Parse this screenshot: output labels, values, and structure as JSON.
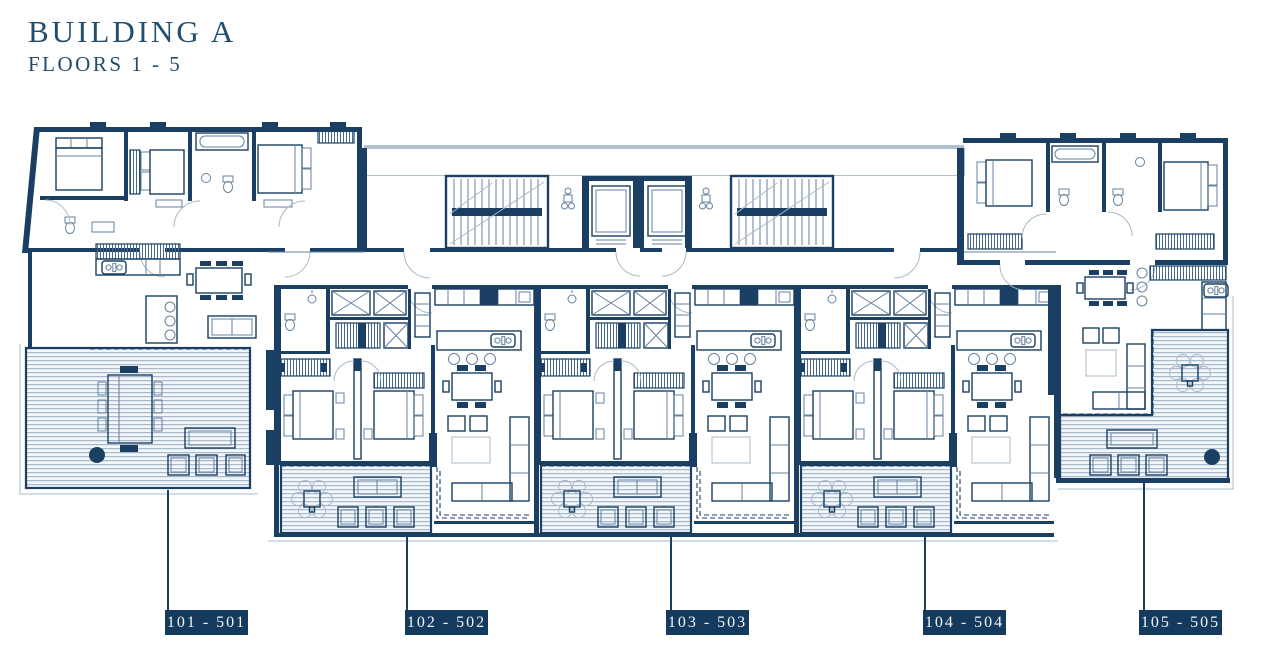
{
  "header": {
    "title": "BUILDING A",
    "subtitle": "FLOORS 1 - 5"
  },
  "units": [
    {
      "id": "unit-101-501",
      "label": "101 - 501"
    },
    {
      "id": "unit-102-502",
      "label": "102 - 502"
    },
    {
      "id": "unit-103-503",
      "label": "103 - 503"
    },
    {
      "id": "unit-104-504",
      "label": "104 - 504"
    },
    {
      "id": "unit-105-505",
      "label": "105 - 505"
    }
  ],
  "plan_features": {
    "core": [
      "staircase-left",
      "elevator-bank",
      "staircase-right",
      "stippled-walkway"
    ],
    "per_unit": [
      "bedrooms",
      "bathrooms",
      "kitchen-island",
      "dining-table",
      "sofa",
      "terrace-deck"
    ]
  },
  "colors": {
    "wall": "#1b3f63",
    "thin": "#64819f",
    "faint": "#a9bac9",
    "deckline": "#96abc0",
    "stipbg": "#e9eef3",
    "stipdot": "#47698f",
    "labelbg": "#143a5e",
    "labeltext": "#f2f5f9",
    "title": "#234d6d",
    "bg": "#ffffff"
  }
}
